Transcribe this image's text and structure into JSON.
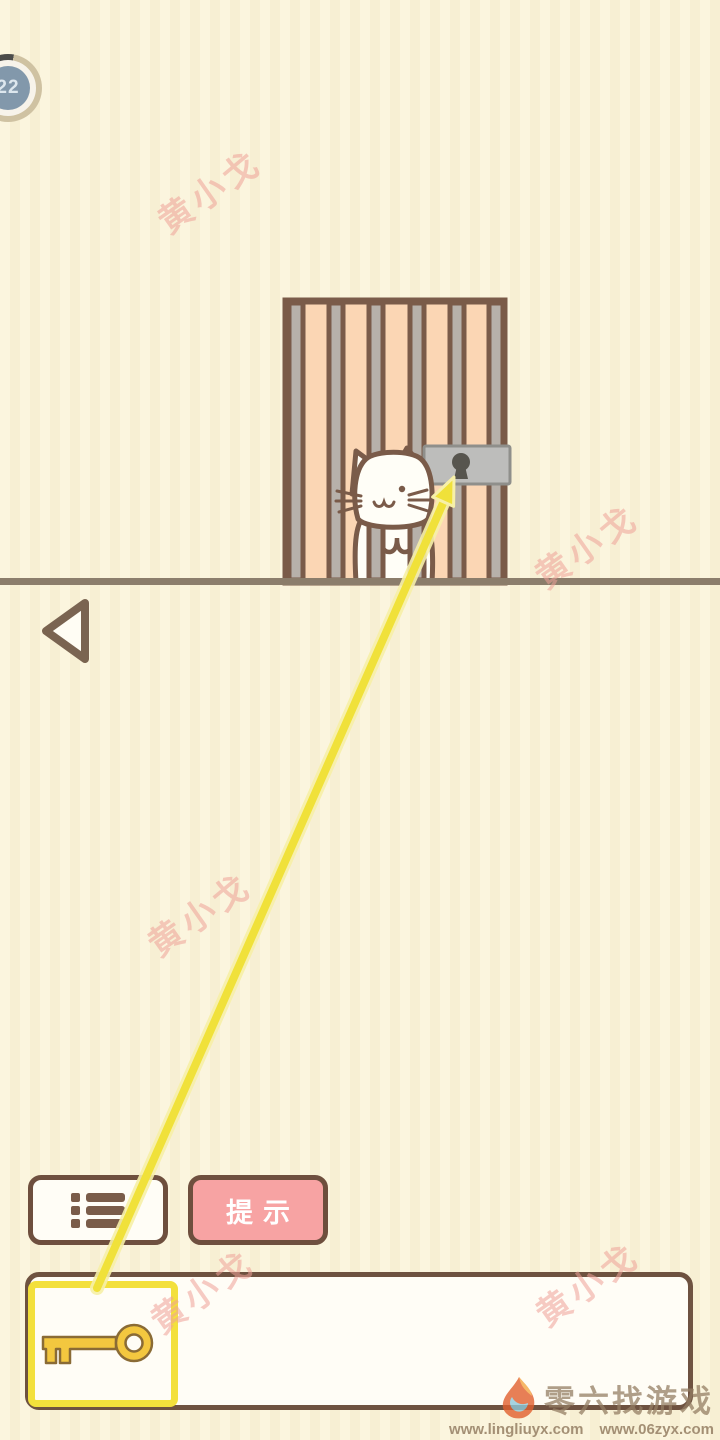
{
  "hud": {
    "level": "22"
  },
  "watermark": {
    "text": "黄小戈",
    "color": "#eea098"
  },
  "buttons": {
    "hint_label": "提示"
  },
  "icons": {
    "menu": "list-icon",
    "back": "back-arrow-icon",
    "key": "key-icon",
    "lock": "padlock-icon",
    "flame": "flame-logo-icon"
  },
  "inventory": {
    "selected_item": "key"
  },
  "footer": {
    "brand": "零六找游戏",
    "urls": [
      "www.lingliuyx.com",
      "www.06zyx.com"
    ]
  },
  "colors": {
    "background": "#faf3d8",
    "cage_fill": "#fbd6b4",
    "frame_brown": "#7a5b49",
    "bar_gray": "#b7b1aa",
    "lock_gray": "#bdbdbb",
    "hint_pink": "#f7a3a3",
    "accent_yellow": "#f0e13a",
    "key_gold": "#f3c73f",
    "badge_blue": "#8298ab",
    "ground": "#8b7d6b"
  }
}
